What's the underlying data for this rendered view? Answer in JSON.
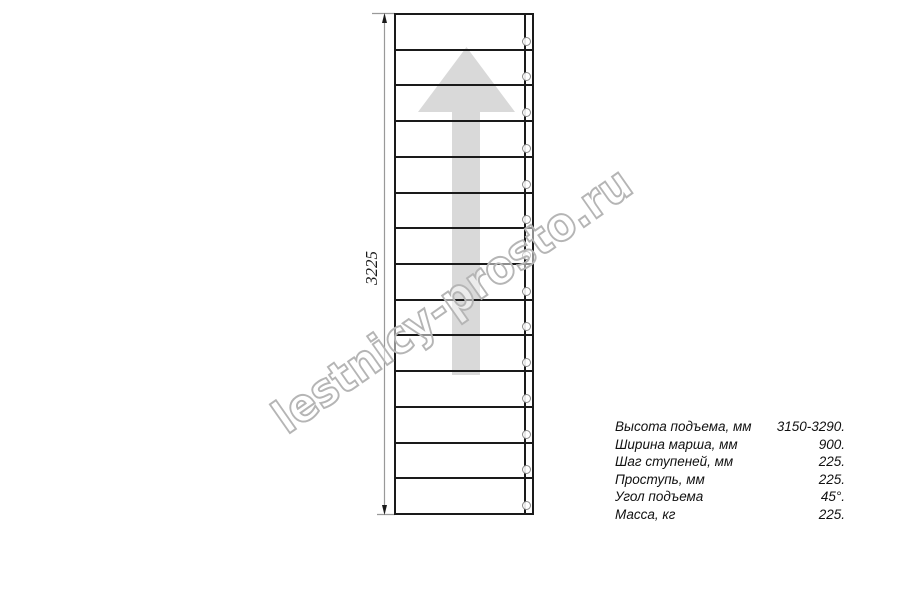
{
  "drawing": {
    "dimension_label": "3225",
    "steps_count": 14,
    "direction_arrow": "up",
    "colors": {
      "outline": "#1a1a1a",
      "dimension_line": "#999999",
      "arrow_fill": "#d9d9d9",
      "watermark": "#b5b5b5"
    }
  },
  "watermark": {
    "text": "lestnicy-prosto.ru"
  },
  "specs": {
    "rows": [
      {
        "label": "Высота подъема, мм",
        "value": "3150-3290."
      },
      {
        "label": "Ширина марша, мм",
        "value": "900."
      },
      {
        "label": "Шаг ступеней, мм",
        "value": "225."
      },
      {
        "label": "Проступь, мм",
        "value": "225."
      },
      {
        "label": "Угол подъема",
        "value": "45°."
      },
      {
        "label": "Масса, кг",
        "value": "225."
      }
    ]
  }
}
